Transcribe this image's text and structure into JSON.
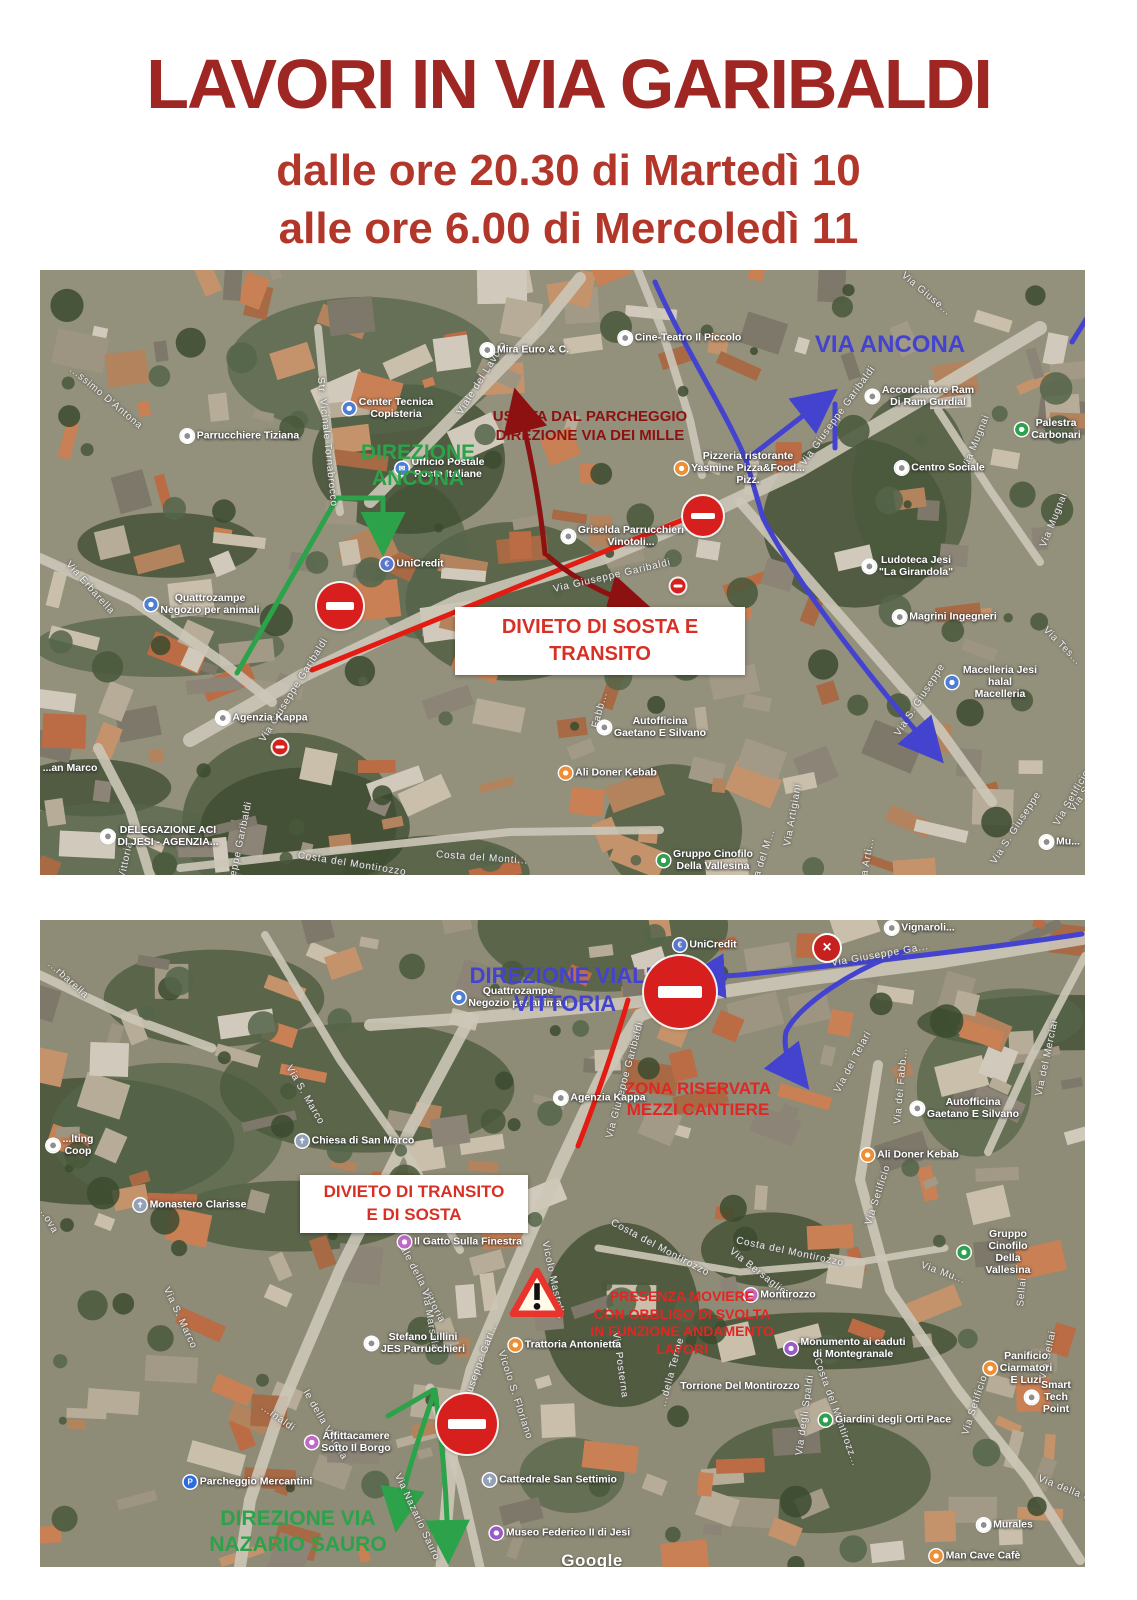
{
  "title": "LAVORI IN VIA GARIBALDI",
  "schedule": {
    "line1": "dalle ore 20.30 di Martedì  10",
    "line2": "alle ore 6.00 di Mercoledì 11"
  },
  "colors": {
    "title_red": "#9e2723",
    "subtitle_red": "#b2362a",
    "notice_red": "#d93025",
    "annotation_green": "#2ca24a",
    "annotation_blue": "#4343d0",
    "annotation_darkred": "#8e1111",
    "route_red": "#e31b12",
    "noentry_red": "#d7201d"
  },
  "map1": {
    "bigs": [
      {
        "lines": [
          "DIREZIONE",
          "ANCONA"
        ],
        "c": "green",
        "x": 378,
        "y": 170,
        "s": 21
      },
      {
        "lines": [
          "USCITA DAL PARCHEGGIO",
          "DIREZIONE VIA DEI MILLE"
        ],
        "c": "darkred",
        "x": 550,
        "y": 138,
        "s": 15
      },
      {
        "lines": [
          "VIA ANCONA"
        ],
        "c": "blue",
        "x": 850,
        "y": 60,
        "s": 24
      }
    ],
    "box": {
      "x": 415,
      "y": 337,
      "w": 290,
      "h": 68,
      "lines": [
        "DIVIETO DI SOSTA E",
        "TRANSITO"
      ],
      "s": 20
    },
    "signs": [
      {
        "k": "noentry",
        "x": 300,
        "y": 336,
        "s": 46
      },
      {
        "k": "noentry",
        "x": 663,
        "y": 246,
        "s": 40
      },
      {
        "k": "mini",
        "x": 638,
        "y": 316,
        "s": 15
      },
      {
        "k": "mini",
        "x": 240,
        "y": 477,
        "s": 15
      }
    ],
    "pois": [
      {
        "t": "Cine-Teatro Il Piccolo",
        "x": 640,
        "y": 68,
        "ic": "generic"
      },
      {
        "t": "Mira Euro & C.",
        "x": 485,
        "y": 80,
        "ic": "generic"
      },
      {
        "t": "Center Tecnica\nCopisteria",
        "x": 348,
        "y": 138,
        "ic": "shop"
      },
      {
        "t": "Parrucchiere Tiziana",
        "x": 200,
        "y": 166,
        "ic": "generic"
      },
      {
        "t": "Ufficio Postale\nPoste Italiane",
        "x": 400,
        "y": 198,
        "ic": "post"
      },
      {
        "t": "Pizzeria ristorante\nYasmine Pizza&Food...\nPizz.",
        "x": 700,
        "y": 198,
        "ic": "food"
      },
      {
        "t": "Acconciatore Ram\nDi Ram Gurdial",
        "x": 880,
        "y": 126,
        "ic": "generic"
      },
      {
        "t": "Palestra Carbonari",
        "x": 1008,
        "y": 159,
        "ic": "park"
      },
      {
        "t": "Centro Sociale",
        "x": 900,
        "y": 198,
        "ic": "generic"
      },
      {
        "t": "Ludoteca Jesi\n\"La Girandola\"",
        "x": 868,
        "y": 296,
        "ic": "generic"
      },
      {
        "t": "Magrini Ingegneri",
        "x": 905,
        "y": 347,
        "ic": "generic"
      },
      {
        "t": "Macelleria Jesi halal\nMacelleria",
        "x": 952,
        "y": 412,
        "ic": "shop"
      },
      {
        "t": "UniCredit",
        "x": 372,
        "y": 294,
        "ic": "bank"
      },
      {
        "t": "Griselda Parrucchieri\nVinotoli...",
        "x": 583,
        "y": 266,
        "ic": "generic"
      },
      {
        "t": "Quattrozampe\nNegozio per animali",
        "x": 162,
        "y": 334,
        "ic": "shop"
      },
      {
        "t": "Agenzia Kappa",
        "x": 222,
        "y": 448,
        "ic": "generic"
      },
      {
        "t": "Ali Doner Kebab",
        "x": 568,
        "y": 503,
        "ic": "food"
      },
      {
        "t": "Autofficina\nGaetano E Silvano",
        "x": 612,
        "y": 457,
        "ic": "generic"
      },
      {
        "t": "Gruppo Cinofilo\nDella Vallesina",
        "x": 665,
        "y": 590,
        "ic": "park"
      },
      {
        "t": "DELEGAZIONE ACI\nDI JESI - AGENZIA...",
        "x": 120,
        "y": 566,
        "ic": "generic"
      },
      {
        "t": "...an Marco",
        "x": 30,
        "y": 498,
        "ic": "none"
      },
      {
        "t": "Mu...",
        "x": 1020,
        "y": 572,
        "ic": "generic"
      }
    ],
    "streets": [
      {
        "t": "Viale del Lavoro",
        "x": 442,
        "y": 108,
        "r": -58
      },
      {
        "t": "Str. Vicinale Tornabrocco",
        "x": 287,
        "y": 172,
        "r": 84
      },
      {
        "t": "...ssimo D'Antona",
        "x": 66,
        "y": 128,
        "r": 40
      },
      {
        "t": "Via Erbarella",
        "x": 50,
        "y": 318,
        "r": 48
      },
      {
        "t": "Via Giuseppe Garibaldi",
        "x": 572,
        "y": 306,
        "r": -13
      },
      {
        "t": "Via Giuseppe Garibaldi",
        "x": 254,
        "y": 420,
        "r": -58
      },
      {
        "t": "...eppe Garibaldi",
        "x": 200,
        "y": 574,
        "r": -78
      },
      {
        "t": "Via Giuseppe Garibaldi",
        "x": 798,
        "y": 146,
        "r": -54
      },
      {
        "t": "Via Giuse...",
        "x": 886,
        "y": 24,
        "r": 40
      },
      {
        "t": "Via Mugnai",
        "x": 936,
        "y": 172,
        "r": -68
      },
      {
        "t": "Via Mugnai",
        "x": 1014,
        "y": 250,
        "r": -68
      },
      {
        "t": "Via S. Giuseppe",
        "x": 880,
        "y": 430,
        "r": -57
      },
      {
        "t": "Via S. Giuseppe",
        "x": 976,
        "y": 558,
        "r": -57
      },
      {
        "t": "Via S. Giuseppe",
        "x": 1056,
        "y": 506,
        "r": -55
      },
      {
        "t": "Via Artigiani",
        "x": 753,
        "y": 545,
        "r": -80
      },
      {
        "t": "Via Arti...",
        "x": 827,
        "y": 592,
        "r": -80
      },
      {
        "t": "Costa del Montirozzo",
        "x": 312,
        "y": 594,
        "r": 9
      },
      {
        "t": "Costa del Monti...",
        "x": 442,
        "y": 588,
        "r": 4
      },
      {
        "t": "Vittoria",
        "x": 86,
        "y": 590,
        "r": -78
      },
      {
        "t": "Via Setificio",
        "x": 1032,
        "y": 528,
        "r": -60
      },
      {
        "t": "Via Tes...",
        "x": 1022,
        "y": 376,
        "r": 45
      },
      {
        "t": "Via del M...",
        "x": 723,
        "y": 588,
        "r": -72
      },
      {
        "t": "Fabb...",
        "x": 560,
        "y": 440,
        "r": -75
      }
    ]
  },
  "map2": {
    "bigs": [
      {
        "lines": [
          "DIREZIONE VIALE",
          "VITTORIA"
        ],
        "c": "blue",
        "x": 525,
        "y": 42,
        "s": 22
      },
      {
        "lines": [
          "ZONA RISERVATA",
          "MEZZI CANTIERE"
        ],
        "c": "red",
        "x": 658,
        "y": 158,
        "s": 17
      },
      {
        "lines": [
          "PRESENZA MOVIERE",
          "CON OBBLIGO DI SVOLTA",
          "IN FUNZIONE ANDAMENTO",
          "LAVORI"
        ],
        "c": "red",
        "x": 642,
        "y": 368,
        "s": 14
      },
      {
        "lines": [
          "DIREZIONE VIA",
          "NAZARIO SAURO"
        ],
        "c": "green",
        "x": 258,
        "y": 586,
        "s": 21
      }
    ],
    "box": {
      "x": 260,
      "y": 255,
      "w": 228,
      "h": 58,
      "lines": [
        "DIVIETO DI TRANSITO",
        "E DI SOSTA"
      ],
      "s": 17
    },
    "signs": [
      {
        "k": "noentry",
        "x": 640,
        "y": 72,
        "s": 72
      },
      {
        "k": "noentry",
        "x": 427,
        "y": 504,
        "s": 60
      },
      {
        "k": "closure",
        "x": 787,
        "y": 28,
        "s": 26
      },
      {
        "k": "warning",
        "x": 497,
        "y": 375,
        "s": 56
      }
    ],
    "pois": [
      {
        "t": "UniCredit",
        "x": 665,
        "y": 25,
        "ic": "bank"
      },
      {
        "t": "Quattrozampe\nNegozio per animali",
        "x": 470,
        "y": 77,
        "ic": "shop"
      },
      {
        "t": "Agenzia Kappa",
        "x": 560,
        "y": 178,
        "ic": "generic"
      },
      {
        "t": "...lting\nCoop",
        "x": 30,
        "y": 225,
        "ic": "generic"
      },
      {
        "t": "Chiesa di San Marco",
        "x": 315,
        "y": 221,
        "ic": "church"
      },
      {
        "t": "Monastero Clarisse",
        "x": 150,
        "y": 285,
        "ic": "church"
      },
      {
        "t": "Il Gatto Sulla Finestra",
        "x": 420,
        "y": 322,
        "ic": "lodging"
      },
      {
        "t": "Stefano Lillini\nJES Parrucchieri",
        "x": 375,
        "y": 423,
        "ic": "generic"
      },
      {
        "t": "Trattoria Antonietta",
        "x": 525,
        "y": 425,
        "ic": "food"
      },
      {
        "t": "Montirozzo",
        "x": 740,
        "y": 375,
        "ic": "lodging"
      },
      {
        "t": "Torrione Del Montirozzo",
        "x": 700,
        "y": 466,
        "ic": "none"
      },
      {
        "t": "Monumento ai caduti\ndi Montegranale",
        "x": 805,
        "y": 428,
        "ic": "museum"
      },
      {
        "t": "Giardini degli Orti Pace",
        "x": 845,
        "y": 500,
        "ic": "park"
      },
      {
        "t": "Panificio\nCiarmatori E Luzi",
        "x": 978,
        "y": 448,
        "ic": "food"
      },
      {
        "t": "Smart Tech Point",
        "x": 1008,
        "y": 477,
        "ic": "generic"
      },
      {
        "t": "Murales",
        "x": 965,
        "y": 605,
        "ic": "generic"
      },
      {
        "t": "Man Cave Cafè",
        "x": 935,
        "y": 636,
        "ic": "food"
      },
      {
        "t": "Cattedrale San Settimio",
        "x": 510,
        "y": 560,
        "ic": "church"
      },
      {
        "t": "Museo Federico II di Jesi",
        "x": 520,
        "y": 613,
        "ic": "museum"
      },
      {
        "t": "Affittacamere\nSotto Il Borgo",
        "x": 308,
        "y": 522,
        "ic": "lodging"
      },
      {
        "t": "Parcheggio Mercantini",
        "x": 208,
        "y": 562,
        "ic": "parking"
      },
      {
        "t": "Autofficina\nGaetano E Silvano",
        "x": 925,
        "y": 188,
        "ic": "generic"
      },
      {
        "t": "Ali Doner Kebab",
        "x": 870,
        "y": 235,
        "ic": "food"
      },
      {
        "t": "Gruppo Cinofilo\nDella Vallesina",
        "x": 960,
        "y": 332,
        "ic": "park"
      },
      {
        "t": "Vignaroli...",
        "x": 880,
        "y": 8,
        "ic": "generic"
      }
    ],
    "streets": [
      {
        "t": "Via Giuseppe Ga...",
        "x": 840,
        "y": 35,
        "r": -10
      },
      {
        "t": "Via Giuseppe Garibaldi",
        "x": 585,
        "y": 160,
        "r": -75
      },
      {
        "t": "Via Giuseppe Gari...",
        "x": 437,
        "y": 452,
        "r": -70
      },
      {
        "t": "...rbarella",
        "x": 28,
        "y": 60,
        "r": 42
      },
      {
        "t": "Via dei Telari",
        "x": 813,
        "y": 142,
        "r": -62
      },
      {
        "t": "Via del Merciai",
        "x": 1058,
        "y": 48,
        "r": -78
      },
      {
        "t": "Via del Merciai",
        "x": 1007,
        "y": 138,
        "r": -78
      },
      {
        "t": "Via dei Fabb...",
        "x": 861,
        "y": 166,
        "r": -85
      },
      {
        "t": "Via Setificio",
        "x": 838,
        "y": 275,
        "r": -72
      },
      {
        "t": "Via Setificio",
        "x": 935,
        "y": 485,
        "r": -72
      },
      {
        "t": "Via S. Marco",
        "x": 265,
        "y": 175,
        "r": 60
      },
      {
        "t": "Via S. Marco",
        "x": 140,
        "y": 398,
        "r": 65
      },
      {
        "t": "Viale della Vittoria",
        "x": 380,
        "y": 360,
        "r": 62
      },
      {
        "t": "le della Vittoria",
        "x": 285,
        "y": 505,
        "r": 60
      },
      {
        "t": "Vicolo Mastella",
        "x": 513,
        "y": 360,
        "r": 78
      },
      {
        "t": "Via Marsala",
        "x": 390,
        "y": 400,
        "r": 80
      },
      {
        "t": "...ova",
        "x": 8,
        "y": 300,
        "r": 60
      },
      {
        "t": "Vicolo S. Floriano",
        "x": 475,
        "y": 475,
        "r": 72
      },
      {
        "t": "Via Posterna",
        "x": 580,
        "y": 445,
        "r": 82
      },
      {
        "t": "Costa del Montirozzo",
        "x": 620,
        "y": 328,
        "r": 28
      },
      {
        "t": "Costa del Montirozzo",
        "x": 750,
        "y": 332,
        "r": 12
      },
      {
        "t": "Via Bersaglie...",
        "x": 722,
        "y": 355,
        "r": 38
      },
      {
        "t": "...della Terme",
        "x": 632,
        "y": 452,
        "r": -75
      },
      {
        "t": "Via degli Spaldi",
        "x": 765,
        "y": 495,
        "r": -82
      },
      {
        "t": "Costa del Montirozz...",
        "x": 796,
        "y": 492,
        "r": 70
      },
      {
        "t": "Via Sellai",
        "x": 1008,
        "y": 435,
        "r": -78
      },
      {
        "t": "Sellai",
        "x": 982,
        "y": 372,
        "r": -85
      },
      {
        "t": "Via della Gra...",
        "x": 1035,
        "y": 573,
        "r": 22
      },
      {
        "t": "Via Nazario Sauro",
        "x": 377,
        "y": 597,
        "r": 65
      },
      {
        "t": "...inaldi",
        "x": 238,
        "y": 498,
        "r": 35
      },
      {
        "t": "Via Mu...",
        "x": 903,
        "y": 353,
        "r": 20
      }
    ],
    "watermark": {
      "t": "Google",
      "x": 552,
      "y": 641
    }
  }
}
